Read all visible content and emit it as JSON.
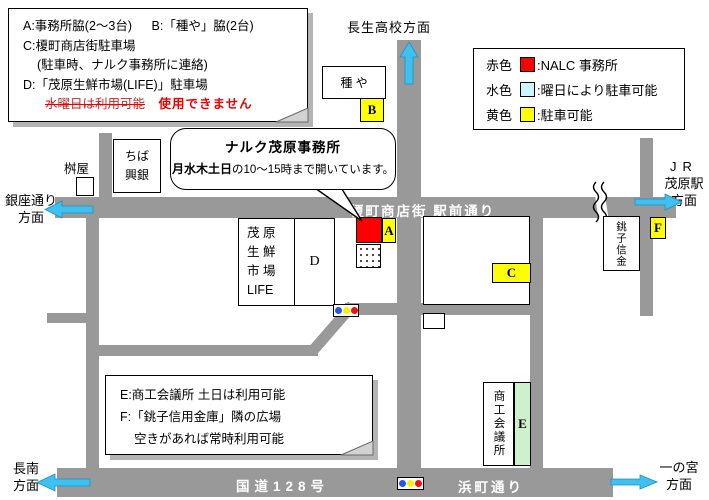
{
  "parking_note": {
    "line1a": "A:事務所脇(2〜3台)",
    "line1b": "B:「種や」脇(2台)",
    "line2": "C:榎町商店街駐車場",
    "line3": "(駐車時、ナルク事務所に連絡)",
    "line4": "D:「茂原生鮮市場(LIFE)」駐車場",
    "line5_struck": "水曜日は利用可能",
    "line5_replacement": "使用できません"
  },
  "color_legend": {
    "rows": [
      {
        "label": "赤色",
        "color": "#FF0000",
        "text": ":NALC 事務所"
      },
      {
        "label": "水色",
        "color": "#CCF5FF",
        "text": ":曜日により駐車可能"
      },
      {
        "label": "黄色",
        "color": "#FFFF00",
        "text": ":駐車可能"
      }
    ]
  },
  "bubble": {
    "title": "ナルク茂原事務所",
    "schedule_days": "月水木土日",
    "schedule_rest": "の10〜15時まで開いています。"
  },
  "usage_note": {
    "line1": "E:商工会議所  土日は利用可能",
    "line2": "F:「銚子信用金庫」隣の広場",
    "line3": "空きがあれば常時利用可能"
  },
  "directions": {
    "north": "長生高校方面",
    "west_upper": [
      "銀座通り",
      "方面"
    ],
    "east_upper": [
      "JR",
      "茂原駅",
      "方面"
    ],
    "west_lower": [
      "長南",
      "方面"
    ],
    "east_lower": [
      "一の宮",
      "方面"
    ]
  },
  "road_labels": {
    "shotengai": "榎町商店街 駅前通り",
    "route128": "国道128号",
    "hamacho": "浜町通り"
  },
  "buildings": {
    "taneya": "種 や",
    "masuya": "桝屋",
    "chiba_kogin": [
      "ちば",
      "興銀"
    ],
    "life": [
      "茂 原",
      "生 鮮",
      "市 場",
      "LIFE"
    ],
    "choshi_shinkin": "銚子信金",
    "chamber_of_commerce": "商工会議所"
  },
  "markers": {
    "a": "A",
    "b": "B",
    "c": "C",
    "d": "D",
    "e": "E",
    "f": "F"
  },
  "colors": {
    "road_gray": "#999999",
    "nalc_red": "#FF0000",
    "parking_yellow": "#FFFF00",
    "day_parking_cyan": "#CCF5FF",
    "chamber_green": "#CCF2CC",
    "arrow_cyan": "#3EC1F0"
  }
}
